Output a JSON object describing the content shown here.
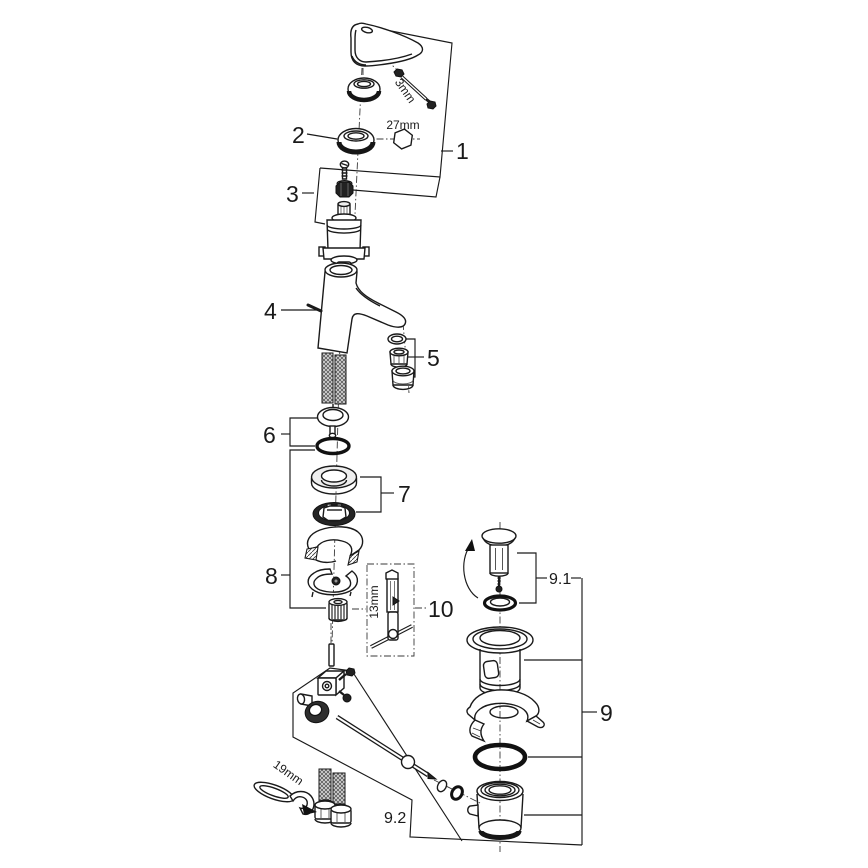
{
  "diagram": {
    "type": "exploded-parts-diagram",
    "subject": "single-lever basin mixer faucet with pop-up waste drain",
    "callouts": {
      "c1": "1",
      "c2": "2",
      "c3": "3",
      "c4": "4",
      "c5": "5",
      "c6": "6",
      "c7": "7",
      "c8": "8",
      "c9": "9",
      "c9_1": "9.1",
      "c9_2": "9.2",
      "c10": "10"
    },
    "dimension_labels": {
      "allen_key": "3mm",
      "cap_hex": "27mm",
      "socket_tool": "13mm",
      "wrench": "19mm"
    },
    "colors": {
      "line": "#1a1a1a",
      "background": "#ffffff",
      "fill_dark": "#222222",
      "fill_shade": "#efefef"
    }
  }
}
